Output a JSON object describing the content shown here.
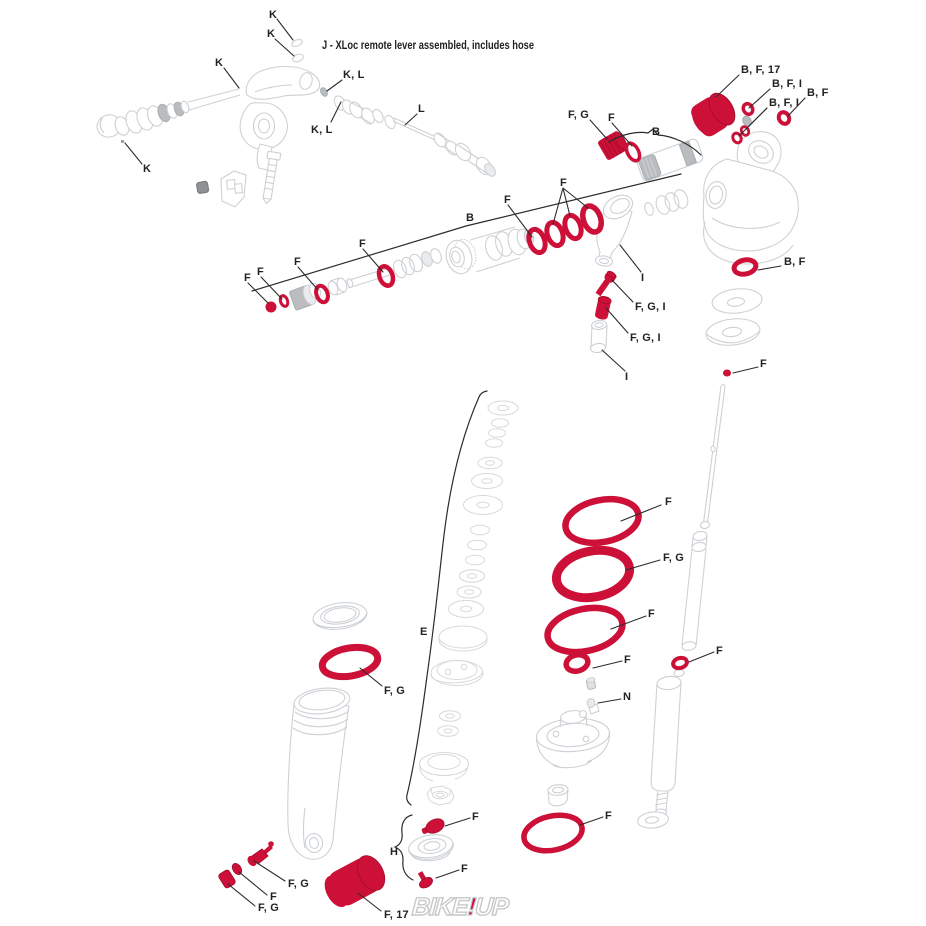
{
  "title": "J - XLoc remote lever assembled, includes hose",
  "watermark": {
    "left": "BIKE",
    "bang": "!",
    "right": "UP"
  },
  "colors": {
    "part_red": "#cc1038",
    "part_red_dark": "#a50d2b",
    "line_art": "#cdd1d5",
    "label_ink": "#222222",
    "watermark_gray": "#c6c8ca"
  },
  "labels": [
    {
      "t": "K",
      "x": 269,
      "y": 18,
      "lines": [
        [
          [
            277,
            19
          ],
          [
            293,
            40
          ]
        ]
      ]
    },
    {
      "t": "K",
      "x": 267,
      "y": 37,
      "lines": [
        [
          [
            275,
            39
          ],
          [
            294,
            56
          ]
        ]
      ]
    },
    {
      "t": "K",
      "x": 215,
      "y": 66,
      "lines": [
        [
          [
            224,
            68
          ],
          [
            239,
            88
          ]
        ]
      ]
    },
    {
      "t": "K, L",
      "x": 343,
      "y": 78,
      "lines": [
        [
          [
            342,
            80
          ],
          [
            327,
            91
          ]
        ]
      ]
    },
    {
      "t": "K, L",
      "x": 311,
      "y": 133,
      "lines": [
        [
          [
            331,
            122
          ],
          [
            341,
            102
          ]
        ]
      ]
    },
    {
      "t": "L",
      "x": 418,
      "y": 112,
      "lines": [
        [
          [
            417,
            114
          ],
          [
            405,
            125
          ]
        ]
      ]
    },
    {
      "t": "K",
      "x": 143,
      "y": 172,
      "lines": [
        [
          [
            125,
            143
          ],
          [
            142,
            164
          ]
        ]
      ]
    },
    {
      "t": "F, G",
      "x": 568,
      "y": 118,
      "lines": [
        [
          [
            590,
            120
          ],
          [
            607,
            139
          ]
        ]
      ]
    },
    {
      "t": "F",
      "x": 608,
      "y": 121,
      "lines": [
        [
          [
            612,
            123
          ],
          [
            632,
            146
          ]
        ]
      ]
    },
    {
      "t": "B",
      "x": 652,
      "y": 135
    },
    {
      "t": "B, F, 17",
      "x": 741,
      "y": 73,
      "lines": [
        [
          [
            739,
            75
          ],
          [
            716,
            97
          ]
        ]
      ]
    },
    {
      "t": "B, F, I",
      "x": 772,
      "y": 87,
      "lines": [
        [
          [
            770,
            89
          ],
          [
            749,
            108
          ]
        ]
      ]
    },
    {
      "t": "B, F",
      "x": 807,
      "y": 96,
      "lines": [
        [
          [
            805,
            98
          ],
          [
            788,
            116
          ]
        ]
      ]
    },
    {
      "t": "B, F, I",
      "x": 769,
      "y": 106,
      "lines": [
        [
          [
            767,
            108
          ],
          [
            746,
            129
          ]
        ],
        [
          [
            767,
            108
          ],
          [
            739,
            136
          ]
        ]
      ]
    },
    {
      "t": "B",
      "x": 466,
      "y": 221
    },
    {
      "t": "F",
      "x": 504,
      "y": 203,
      "lines": [
        [
          [
            508,
            205
          ],
          [
            532,
            237
          ]
        ]
      ]
    },
    {
      "t": "F",
      "x": 560,
      "y": 186,
      "lines": [
        [
          [
            563,
            188
          ],
          [
            553,
            224
          ]
        ],
        [
          [
            563,
            188
          ],
          [
            570,
            216
          ]
        ],
        [
          [
            563,
            188
          ],
          [
            588,
            208
          ]
        ]
      ]
    },
    {
      "t": "F",
      "x": 244,
      "y": 281,
      "lines": [
        [
          [
            248,
            283
          ],
          [
            268,
            303
          ]
        ]
      ]
    },
    {
      "t": "F",
      "x": 257,
      "y": 275,
      "lines": [
        [
          [
            261,
            277
          ],
          [
            282,
            299
          ]
        ]
      ]
    },
    {
      "t": "F",
      "x": 294,
      "y": 265,
      "lines": [
        [
          [
            298,
            267
          ],
          [
            318,
            290
          ]
        ]
      ]
    },
    {
      "t": "F",
      "x": 359,
      "y": 247,
      "lines": [
        [
          [
            363,
            249
          ],
          [
            383,
            272
          ]
        ]
      ]
    },
    {
      "t": "I",
      "x": 641,
      "y": 281,
      "lines": [
        [
          [
            641,
            272
          ],
          [
            620,
            245
          ]
        ]
      ]
    },
    {
      "t": "F, G, I",
      "x": 635,
      "y": 310,
      "lines": [
        [
          [
            633,
            302
          ],
          [
            612,
            280
          ]
        ]
      ]
    },
    {
      "t": "F, G, I",
      "x": 630,
      "y": 341,
      "lines": [
        [
          [
            628,
            333
          ],
          [
            606,
            308
          ]
        ]
      ]
    },
    {
      "t": "I",
      "x": 625,
      "y": 380,
      "lines": [
        [
          [
            625,
            371
          ],
          [
            602,
            350
          ]
        ]
      ]
    },
    {
      "t": "B, F",
      "x": 784,
      "y": 265,
      "lines": [
        [
          [
            781,
            266
          ],
          [
            758,
            270
          ]
        ]
      ]
    },
    {
      "t": "F",
      "x": 760,
      "y": 367,
      "lines": [
        [
          [
            758,
            367
          ],
          [
            733,
            373
          ]
        ]
      ]
    },
    {
      "t": "F",
      "x": 665,
      "y": 505,
      "lines": [
        [
          [
            661,
            505
          ],
          [
            621,
            521
          ]
        ]
      ]
    },
    {
      "t": "F, G",
      "x": 663,
      "y": 561,
      "lines": [
        [
          [
            660,
            560
          ],
          [
            626,
            570
          ]
        ]
      ]
    },
    {
      "t": "F",
      "x": 648,
      "y": 617,
      "lines": [
        [
          [
            646,
            616
          ],
          [
            611,
            629
          ]
        ]
      ]
    },
    {
      "t": "F",
      "x": 624,
      "y": 663,
      "lines": [
        [
          [
            622,
            661
          ],
          [
            593,
            668
          ]
        ]
      ]
    },
    {
      "t": "N",
      "x": 623,
      "y": 700,
      "lines": [
        [
          [
            621,
            699
          ],
          [
            598,
            703
          ]
        ]
      ]
    },
    {
      "t": "F",
      "x": 716,
      "y": 654,
      "lines": [
        [
          [
            714,
            652
          ],
          [
            689,
            662
          ]
        ]
      ]
    },
    {
      "t": "E",
      "x": 420,
      "y": 635
    },
    {
      "t": "F, G",
      "x": 384,
      "y": 694,
      "lines": [
        [
          [
            382,
            686
          ],
          [
            360,
            668
          ]
        ]
      ]
    },
    {
      "t": "F",
      "x": 472,
      "y": 820,
      "lines": [
        [
          [
            470,
            818
          ],
          [
            445,
            826
          ]
        ]
      ]
    },
    {
      "t": "H",
      "x": 390,
      "y": 855
    },
    {
      "t": "F",
      "x": 461,
      "y": 872,
      "lines": [
        [
          [
            459,
            870
          ],
          [
            436,
            878
          ]
        ]
      ]
    },
    {
      "t": "F",
      "x": 605,
      "y": 819,
      "lines": [
        [
          [
            603,
            817
          ],
          [
            580,
            825
          ]
        ]
      ]
    },
    {
      "t": "F, G",
      "x": 288,
      "y": 887,
      "lines": [
        [
          [
            285,
            881
          ],
          [
            254,
            861
          ]
        ]
      ]
    },
    {
      "t": "F",
      "x": 270,
      "y": 900,
      "lines": [
        [
          [
            267,
            895
          ],
          [
            239,
            872
          ]
        ]
      ]
    },
    {
      "t": "F, G",
      "x": 258,
      "y": 911,
      "lines": [
        [
          [
            255,
            906
          ],
          [
            228,
            884
          ]
        ]
      ]
    },
    {
      "t": "F, 17",
      "x": 384,
      "y": 918,
      "lines": [
        [
          [
            381,
            911
          ],
          [
            358,
            893
          ]
        ]
      ]
    }
  ]
}
